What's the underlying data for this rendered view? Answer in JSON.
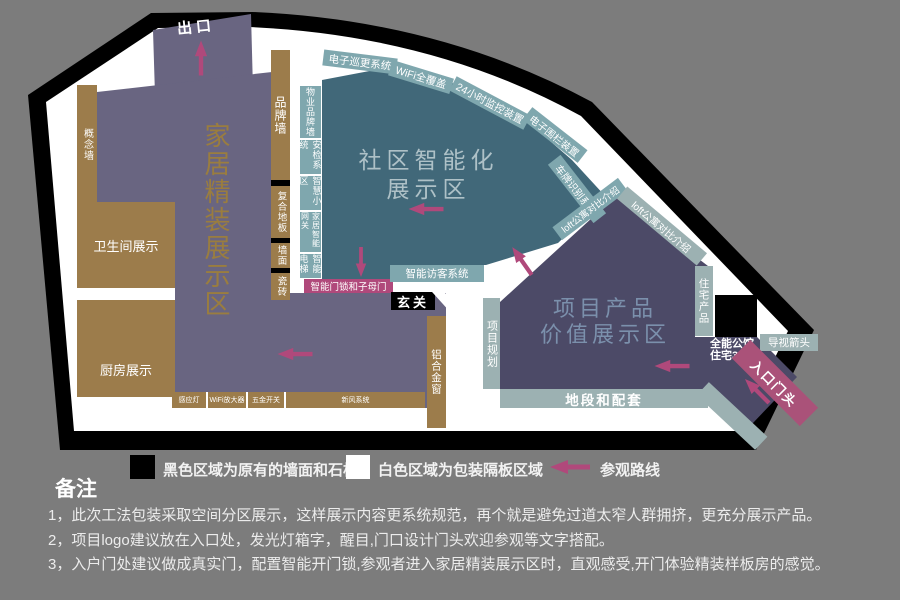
{
  "palette": {
    "background": "#7c7c7c",
    "wall_black": "#000000",
    "partition_white": "#ffffff",
    "home_zone_purple": "#696581",
    "community_zone_teal": "#416879",
    "project_zone_purple": "#4c4a67",
    "wood_brown": "#9c7c4b",
    "label_strip_teal": "#7fa7ae",
    "label_strip_gray_teal": "#9cb1b2",
    "route_pink": "#b0497b",
    "entrance_pink": "#aa5279",
    "home_label_gold": "#9a7d3f",
    "community_label": "#aec1c7",
    "project_label": "#7b90ac"
  },
  "plan": {
    "exit_label": "出口",
    "zones": {
      "home": {
        "label": "家居精装展示区"
      },
      "community": {
        "line1": "社区智能化",
        "line2": "展示区"
      },
      "project": {
        "line1": "项目产品",
        "line2": "价值展示区"
      }
    },
    "left_column": {
      "concept_wall": "概念墙",
      "bathroom": "卫生间展示",
      "kitchen": "厨房展示"
    },
    "brand_column": {
      "brand_wall": "品牌墙",
      "composite_floor": "复合地板",
      "wall_face": "墙面",
      "tile": "瓷砖"
    },
    "smart_column": {
      "items": [
        "物业品牌墙",
        "安检系统",
        "智慧小区",
        "家居智能网关",
        "智能电梯"
      ]
    },
    "arc_strips": {
      "patrol": "电子巡更系统",
      "wifi": "WiFi全覆盖",
      "cctv": "24小时监控装置",
      "fence": "电子围栏装置",
      "plate": "车牌识别系统",
      "loft_inner": "loft公寓对比介绍",
      "loft_outer": "loft公寓对比介绍"
    },
    "visitor_strip": "智能访客系统",
    "doorlock_bar": "智能门锁和子母门",
    "hallway": "玄关",
    "aluminum_window": "铝合金窗",
    "bottom_strip": {
      "items": [
        "感应灯",
        "WiFi放大器",
        "五金开关",
        "新风系统"
      ]
    },
    "project_planning": "项目规划",
    "location_strip": "地段和配套",
    "residential_product": "住宅产品",
    "guide_arrow_strip": "导视箭头",
    "mansion": {
      "line1": "全能公馆",
      "line2": "住宅3.0"
    },
    "entrance_strip": "入口门头"
  },
  "legend": {
    "black_label": "黑色区域为原有的墙面和石柱",
    "white_label": "白色区域为包装隔板区域",
    "route_label": "参观路线"
  },
  "notes": {
    "title": "备注",
    "items": [
      "1，此次工法包装采取空间分区展示，这样展示内容更系统规范，再个就是避免过道太窄人群拥挤，更充分展示产品。",
      "2，项目logo建议放在入口处，发光灯箱字，醒目,门口设计门头欢迎参观等文字搭配。",
      "3，入户门处建议做成真实门，配置智能开门锁,参观者进入家居精装展示区时，直观感受,开门体验精装样板房的感觉。"
    ]
  }
}
